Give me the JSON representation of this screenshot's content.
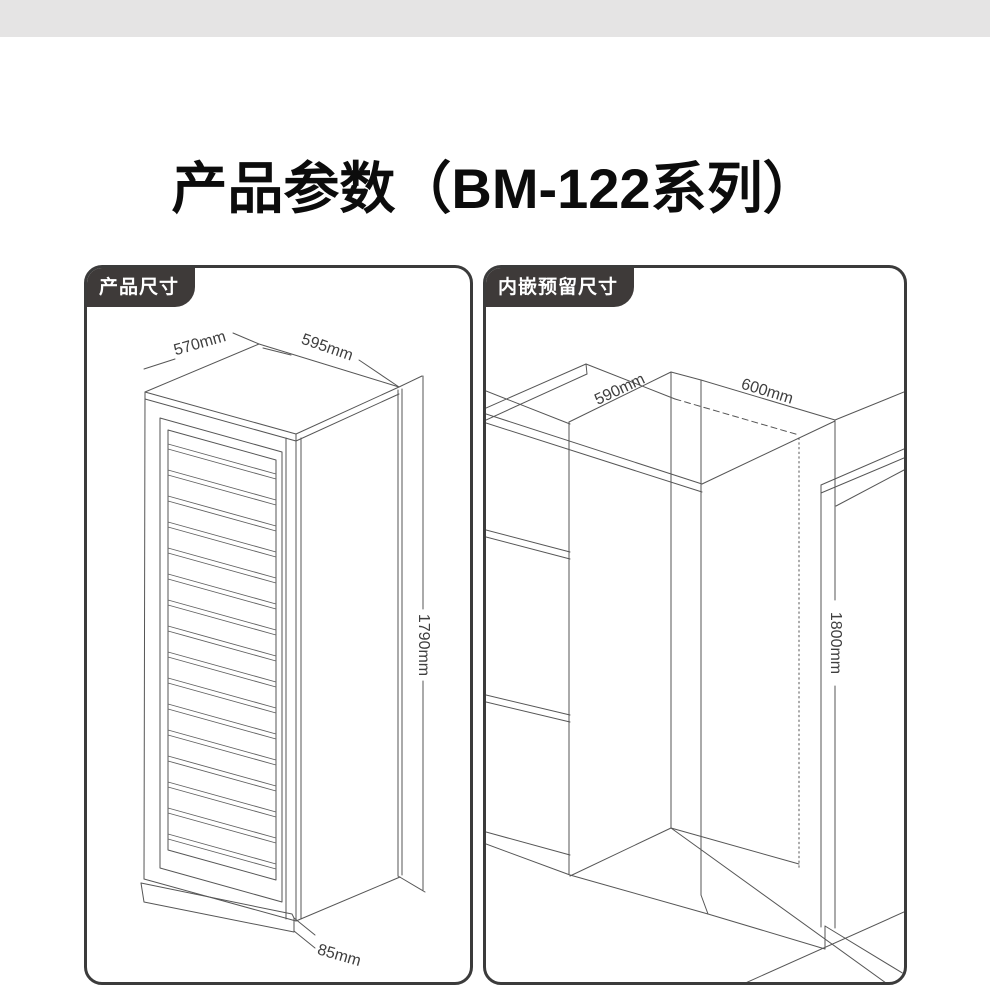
{
  "title": "产品参数（BM-122系列）",
  "panels": {
    "product_size": {
      "label": "产品尺寸",
      "dims": {
        "depth": "570mm",
        "width": "595mm",
        "height": "1790mm",
        "base_height": "85mm"
      }
    },
    "builtin_reserved": {
      "label": "内嵌预留尺寸",
      "dims": {
        "depth": "590mm",
        "width": "600mm",
        "height": "1800mm"
      }
    }
  },
  "colors": {
    "top_bar": "#e5e4e4",
    "tab_background": "#3e3a39",
    "tab_text": "#ffffff",
    "panel_border": "#3b3b3b",
    "drawing_line": "#565656",
    "title_text": "#0c0c0c"
  }
}
